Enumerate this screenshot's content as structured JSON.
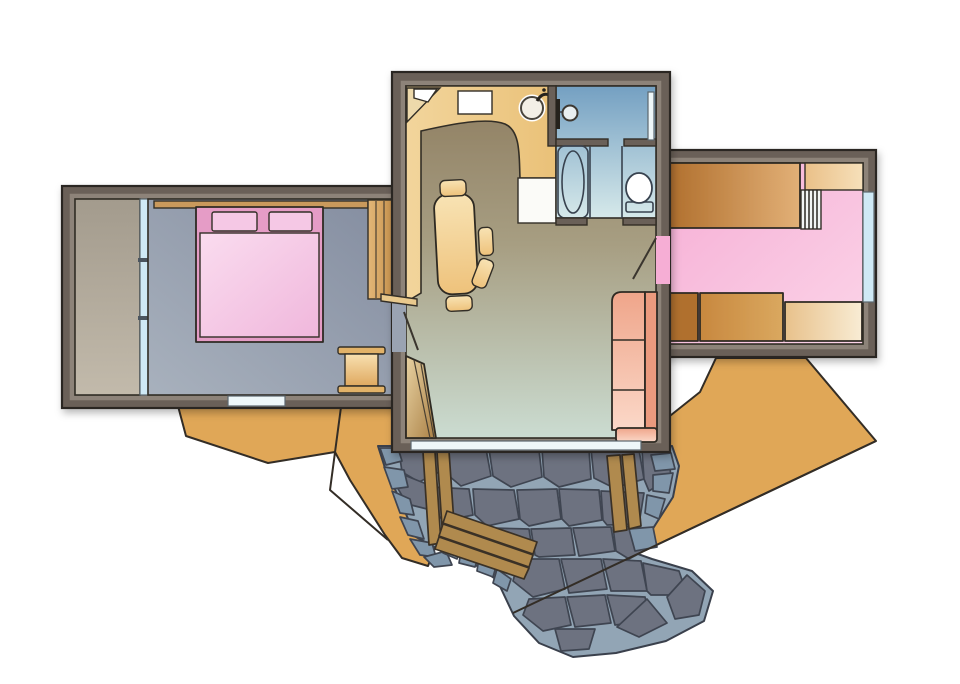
{
  "meta": {
    "type": "floor-plan-illustration",
    "description": "Hand-drawn style cabin floor plan with three wings and a flagstone path"
  },
  "palette": {
    "bg": "#ffffff",
    "wall": "#6b6158",
    "wall_inner": "#8d8379",
    "ground": "#e0a757",
    "stone_base": "#92a5b5",
    "stone_dark": "#6d7280",
    "stone_light": "#8096aa",
    "plank": "#b08a4e",
    "wood_light": "#e8d2a2",
    "wood_dark": "#aa8045",
    "kitchen_light": "#f2d59c",
    "kitchen": "#eac178",
    "living_top": "#8e7d60",
    "living_mid": "#a79e82",
    "living_bottom": "#cbdcd1",
    "bath_top": "#74a0c2",
    "bath_bottom": "#d6e9ea",
    "bedroom_top": "#848da0",
    "bedroom_bottom": "#a8b1bd",
    "opening_slate": "#9aa3b2",
    "porch_top": "#a39b8d",
    "porch_bottom": "#c2baab",
    "pink": "#f6aed5",
    "pink_light": "#fbd4e8",
    "bed_frame": "#e59cc6",
    "spread_light": "#fadcef",
    "spread": "#f0b7dc",
    "pillow": "#f5c8e5",
    "sofa": "#efa58a",
    "sofa_light": "#fbd8c8",
    "table_light": "#f8e3b4",
    "table": "#eec27b",
    "glass": "#cfe9f5",
    "glass_white": "#eef7f9",
    "white": "#ffffff",
    "counter_white": "#fbfbf8",
    "platform_dark": "#b06f2d",
    "platform_light": "#e2b077",
    "cab_mid_a": "#c8883f",
    "cab_mid_b": "#daa85f",
    "cab_right_a": "#e8c18b",
    "cab_right_b": "#f8ecd4",
    "shelf_tr_a": "#eac088",
    "shelf_tr_b": "#f6e0ba",
    "shelf_wood": "#c9995c",
    "flange": "#e2b267",
    "night_a": "#f8e0b0",
    "night_b": "#dfa960",
    "wardrobe_a": "#e3b778",
    "wardrobe_b": "#c9944f",
    "door_leaf": "#e9c98d",
    "corner_cab": "#edd9ab",
    "ladder_bg": "#f2f4f4",
    "fixture": "#ffffff",
    "tub_deck": "#eef3f3",
    "tank": "#e6ecee",
    "knob": "#e8eef0",
    "metal": "#26231f",
    "tick": "#4c545e"
  },
  "rooms": [
    {
      "name": "porch"
    },
    {
      "name": "bedroom"
    },
    {
      "name": "kitchen"
    },
    {
      "name": "living-dining-room"
    },
    {
      "name": "bathroom"
    },
    {
      "name": "bunk-room"
    },
    {
      "name": "stone-patio-path"
    }
  ],
  "furniture": [
    "wall-shelf",
    "double-bed",
    "pillow",
    "nightstand",
    "wardrobe",
    "glass-partition",
    "corner-cabinet",
    "stove",
    "kitchen-sink",
    "kitchen-counter",
    "shower",
    "bathtub",
    "toilet",
    "dining-table",
    "chair",
    "sofa",
    "interior-stairs",
    "door",
    "loft-platform",
    "loft-ladder",
    "storage-cabinet",
    "window",
    "sliding-glass-door",
    "wooden-steps",
    "flagstones"
  ]
}
